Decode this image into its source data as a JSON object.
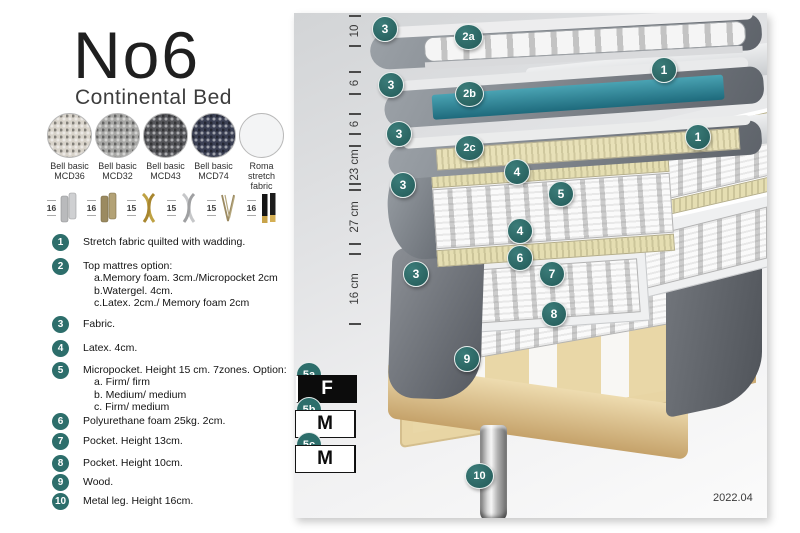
{
  "header": {
    "title": "No6",
    "subtitle": "Continental Bed"
  },
  "fabrics": [
    {
      "line1": "Bell basic",
      "line2": "MCD36",
      "color": "#d8d3ca"
    },
    {
      "line1": "Bell basic",
      "line2": "MCD32",
      "color": "#a7a7a5"
    },
    {
      "line1": "Bell basic",
      "line2": "MCD43",
      "color": "#55565a"
    },
    {
      "line1": "Bell basic",
      "line2": "MCD74",
      "color": "#3b4054"
    },
    {
      "line1": "Roma",
      "line2": "stretch fabric",
      "color": "#f3f4f5"
    }
  ],
  "legs": [
    {
      "height": "16",
      "icon": "cylinder-silver-leg"
    },
    {
      "height": "16",
      "icon": "cylinder-bronze-leg"
    },
    {
      "height": "15",
      "icon": "twisted-gold-leg"
    },
    {
      "height": "15",
      "icon": "twisted-silver-leg"
    },
    {
      "height": "15",
      "icon": "hairpin-leg"
    },
    {
      "height": "16",
      "icon": "tapered-black-gold-leg"
    }
  ],
  "legend": [
    {
      "num": "1",
      "text": "Stretch fabric quilted with wadding."
    },
    {
      "num": "2",
      "text": "Top mattres option:",
      "sub": [
        "a.Memory foam. 3cm./Micropocket 2cm",
        "b.Watergel. 4cm.",
        "c.Latex. 2cm./ Memory foam 2cm"
      ]
    },
    {
      "num": "3",
      "text": "Fabric."
    },
    {
      "num": "4",
      "text": "Latex. 4cm."
    },
    {
      "num": "5",
      "text": "Micropocket. Height 15 cm. 7zones. Option:",
      "sub": [
        "a. Firm/ firm",
        "b. Medium/ medium",
        "c. Firm/ medium"
      ]
    },
    {
      "num": "6",
      "text": "Polyurethane foam 25kg. 2cm."
    },
    {
      "num": "7",
      "text": "Pocket. Height 13cm."
    },
    {
      "num": "8",
      "text": "Pocket. Height 10cm."
    },
    {
      "num": "9",
      "text": "Wood."
    },
    {
      "num": "10",
      "text": "Metal leg. Height 16cm."
    }
  ],
  "diagram": {
    "dimensions": [
      {
        "label": "10"
      },
      {
        "label": "6"
      },
      {
        "label": "6"
      },
      {
        "label": "23 cm"
      },
      {
        "label": "27 cm"
      },
      {
        "label": "16 cm"
      }
    ],
    "badges": [
      {
        "label": "3"
      },
      {
        "label": "2a"
      },
      {
        "label": "1"
      },
      {
        "label": "3"
      },
      {
        "label": "2b"
      },
      {
        "label": "1"
      },
      {
        "label": "3"
      },
      {
        "label": "2c"
      },
      {
        "label": "4"
      },
      {
        "label": "5"
      },
      {
        "label": "3"
      },
      {
        "label": "4"
      },
      {
        "label": "6"
      },
      {
        "label": "7"
      },
      {
        "label": "3"
      },
      {
        "label": "8"
      },
      {
        "label": "9"
      },
      {
        "label": "10"
      }
    ],
    "version": "2022.04"
  },
  "firmness": {
    "rows": [
      {
        "label": "5a",
        "cells": [
          {
            "text": "F",
            "variant": "dark"
          },
          {
            "text": "F",
            "variant": "dark"
          }
        ]
      },
      {
        "label": "5b",
        "cells": [
          {
            "text": "M",
            "variant": "light"
          },
          {
            "text": "M",
            "variant": "light"
          }
        ]
      },
      {
        "label": "5c",
        "cells": [
          {
            "text": "F",
            "variant": "dark"
          },
          {
            "text": "M",
            "variant": "light"
          }
        ]
      }
    ]
  },
  "colors": {
    "badge_teal": "#2d6e6b",
    "watergel_teal": "#2f8091",
    "latex_khaki": "#d9d2a2",
    "wood": "#e8d5a4"
  }
}
